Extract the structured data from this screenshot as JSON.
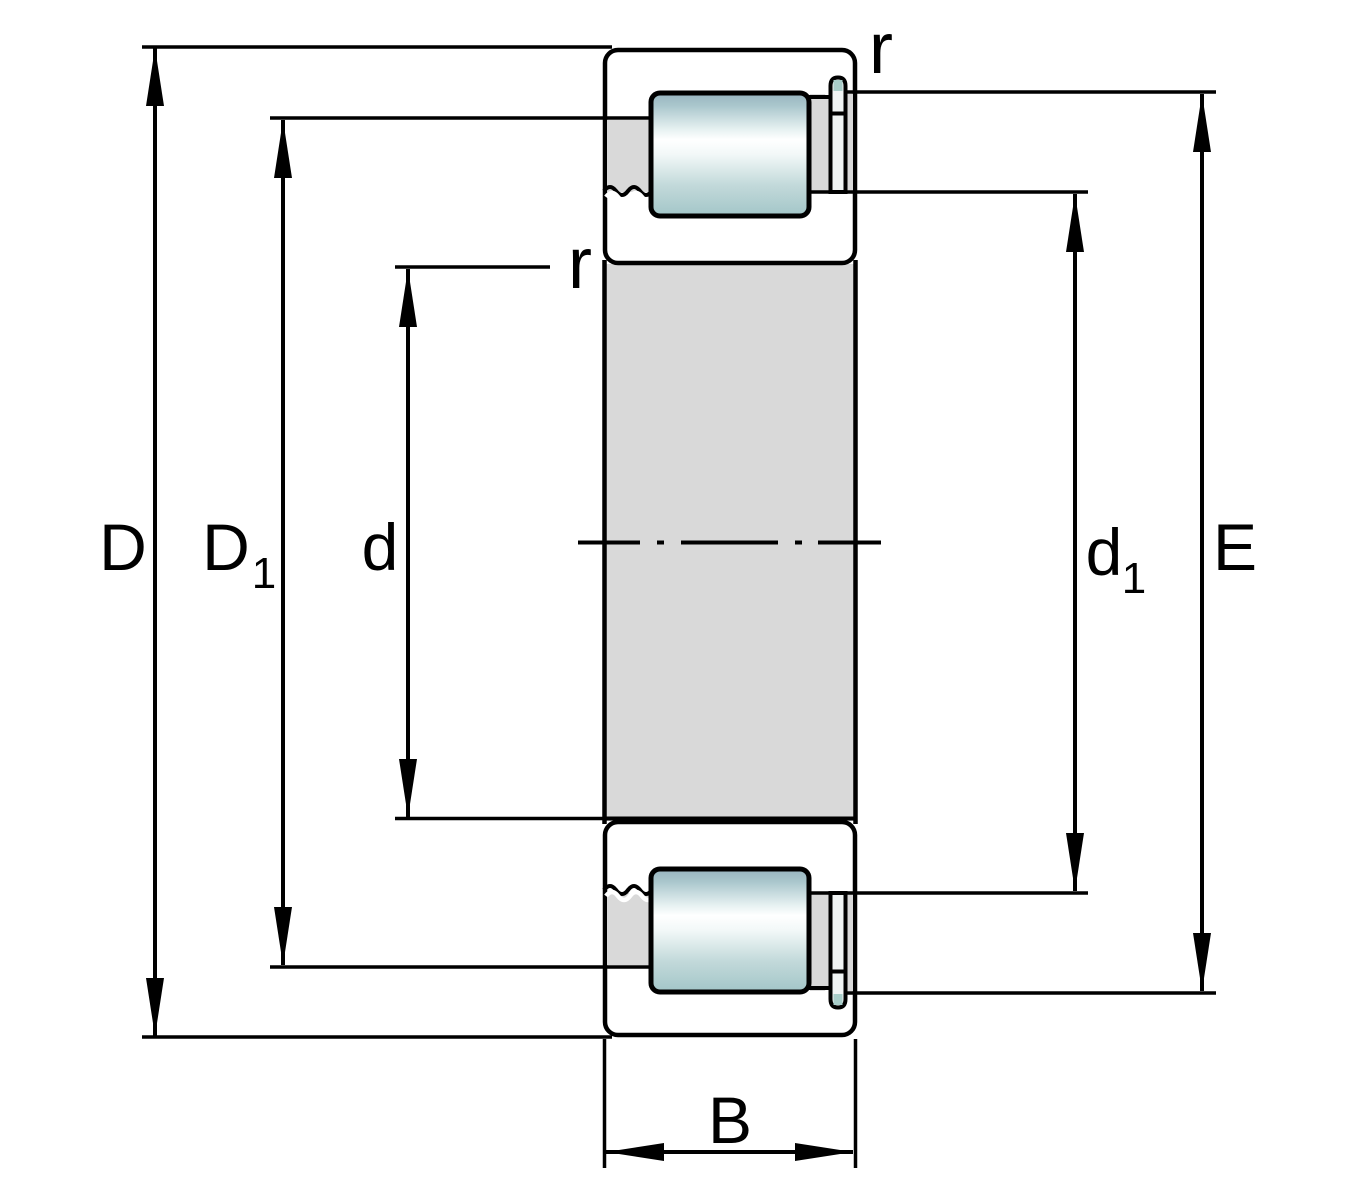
{
  "labels": {
    "D": {
      "base": "D",
      "sub": ""
    },
    "D1": {
      "base": "D",
      "sub": "1"
    },
    "d": {
      "base": "d",
      "sub": ""
    },
    "d1": {
      "base": "d",
      "sub": "1"
    },
    "E": {
      "base": "E",
      "sub": ""
    },
    "B": {
      "base": "B",
      "sub": ""
    },
    "r_top": "r",
    "r_left": "r"
  },
  "colors": {
    "line": "#000000",
    "background": "#ffffff",
    "ring_teal": "#a8cdc9",
    "steel_gray": "#d9d9d9",
    "pin_fill": "#f0f4f4",
    "highlight_white": "#ffffff",
    "roller": {
      "s0": "#98b4bf",
      "s1": "#a9c6cc",
      "s2": "#e8f2f2",
      "s3": "#ffffff",
      "s4": "#f2f8f8",
      "s5": "#c2d9da",
      "s6": "#a3c6c8"
    }
  }
}
